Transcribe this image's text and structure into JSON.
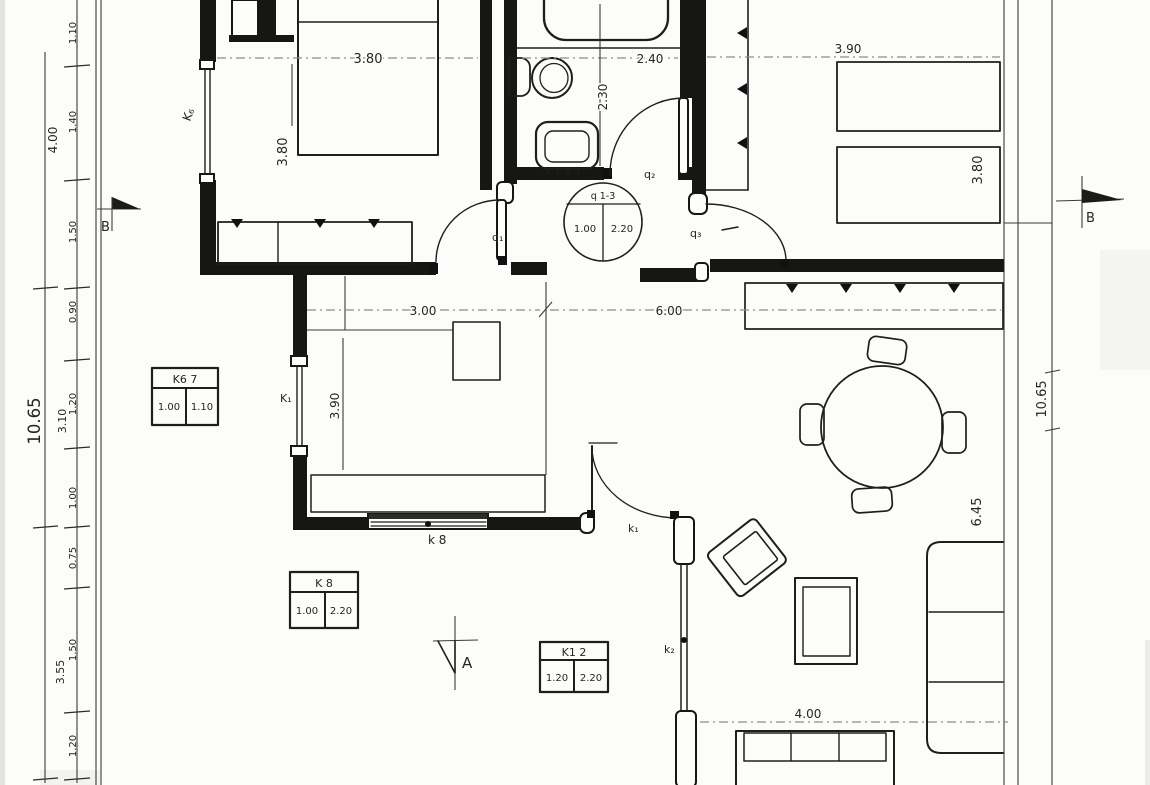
{
  "sheet": {
    "section_a_label": "A",
    "section_b_label": "B"
  },
  "colors": {
    "ink": "#1e1e1c",
    "paper": "#fcfcfa",
    "dim_line": "#8d8d8b"
  },
  "dims_left": {
    "total": "10.65",
    "sub": [
      "4.00",
      "3.10",
      "3.55"
    ],
    "chain": [
      "1.10",
      "1.40",
      "1.50",
      "0.90",
      "1.20",
      "1.00",
      "0.75",
      "1.50",
      "1.20"
    ]
  },
  "dims_right": {
    "total": "10.65"
  },
  "rooms": {
    "bedroom1": {
      "width": "3.80",
      "height": "3.80"
    },
    "bathroom": {
      "width": "2.40",
      "height": "2.30"
    },
    "bedroom2": {
      "width": "3.90",
      "height": "3.80"
    },
    "kitchen": {
      "width": "3.00",
      "height": "3.90"
    },
    "living": {
      "width": "6.00",
      "height": "6.45",
      "sofa_wall": "4.00"
    }
  },
  "labels": {
    "q1": "q₁",
    "q2": "q₂",
    "q3": "q₃",
    "k6": "K₆",
    "k1_window": "K₁",
    "k8": "k 8",
    "k1_door": "k₁",
    "k2": "k₂"
  },
  "schedules": {
    "doors": {
      "header": "q 1-3",
      "width": "1.00",
      "height": "2.20"
    },
    "k67": {
      "header": "K6 7",
      "width": "1.00",
      "height": "1.10"
    },
    "k8": {
      "header": "K 8",
      "width": "1.00",
      "height": "2.20"
    },
    "k12": {
      "header": "K1 2",
      "width": "1.20",
      "height": "2.20"
    }
  }
}
